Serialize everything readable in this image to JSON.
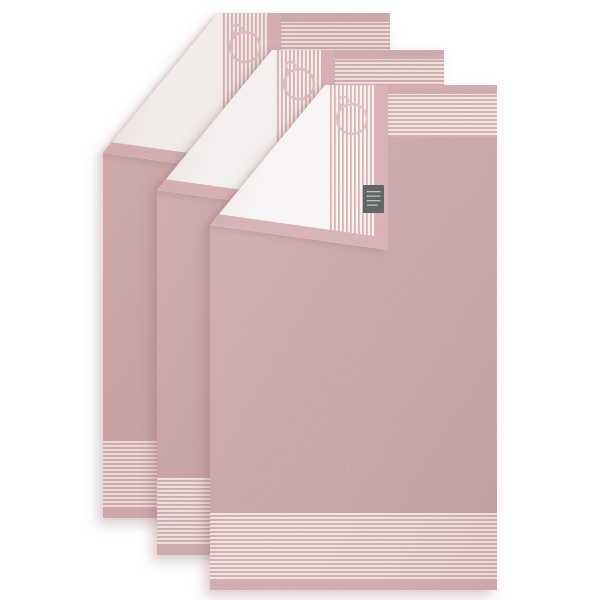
{
  "meta": {
    "type": "product-photo",
    "subject": "Set of three dusty-rose bath towels overlapping in a diagonal cascade, each with its corner folded over to show a white pin-striped reverse side",
    "background_color": "#ffffff"
  },
  "towel_set": {
    "count": 3,
    "layers": [
      "back",
      "middle",
      "front"
    ],
    "features": {
      "top_border": "solid rose hem above a band of fine horizontal stripes",
      "bottom_border": "band of fine horizontal stripes above a solid rose hem",
      "fold_reverse": "white terry with fine vertical rose pinstripes, rose hem edges and a stitched ring emblem"
    }
  },
  "brand_tag": {
    "present_on": "front towel fold hem",
    "background": "#3b403f",
    "text_legible": false,
    "text_line_count": 4
  },
  "ring_emblem": {
    "shape": "stitched ring with small hook",
    "visible_count": 3
  },
  "colors": {
    "background": "#ffffff",
    "body_light": "#c99c9e",
    "body_mid": "#c09395",
    "body_dark": "#b78a8c",
    "hem": "#c59a9b",
    "band_pink": "#c89c9d",
    "band_cream": "#efe4e1",
    "flap_white": "#f6f3f2",
    "fold_hem": "#cfa2a4",
    "fold_stripe_cream": "#f4eeeb",
    "fold_stripe_pink": "#cfa2a3",
    "ring": "#dab4b4",
    "tag": "#3b403f",
    "tag_text": "#a9b0ae",
    "shadow": "#8d5f62"
  }
}
